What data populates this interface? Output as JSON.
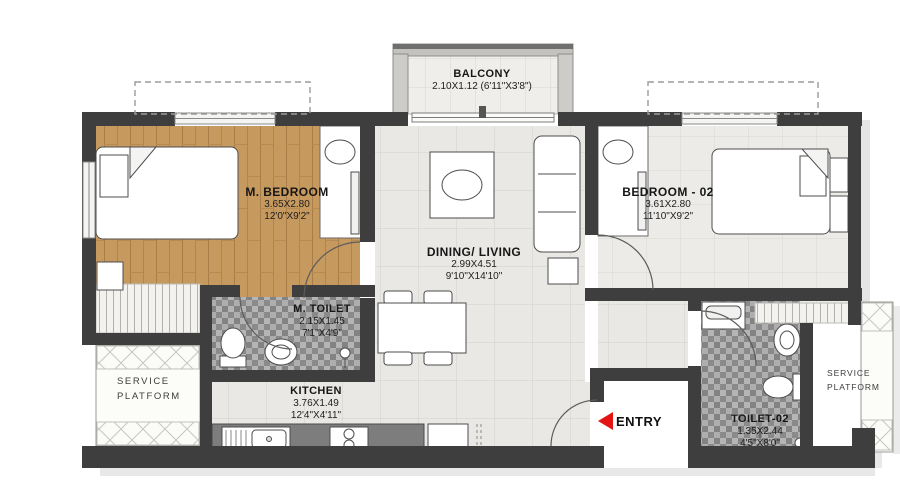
{
  "plan": {
    "balcony": {
      "name": "BALCONY",
      "dim": "2.10X1.12 (6'11\"X3'8\")"
    },
    "master_bedroom": {
      "name": "M. BEDROOM",
      "dim_m": "3.65X2.80",
      "dim_ft": "12'0\"X9'2\""
    },
    "bedroom_02": {
      "name": "BEDROOM - 02",
      "dim_m": "3.61X2.80",
      "dim_ft": "11'10\"X9'2\""
    },
    "dining_living": {
      "name": "DINING/ LIVING",
      "dim_m": "2.99X4.51",
      "dim_ft": "9'10\"X14'10\""
    },
    "master_toilet": {
      "name": "M. TOILET",
      "dim_m": "2.15X1.45",
      "dim_ft": "7'1\"X4'9\""
    },
    "kitchen": {
      "name": "KITCHEN",
      "dim_m": "3.76X1.49",
      "dim_ft": "12'4\"X4'11\""
    },
    "toilet_02": {
      "name": "TOILET-02",
      "dim_m": "1.35X2.44",
      "dim_ft": "4'5\"X8'0\""
    },
    "service_platform_left": {
      "line1": "SERVICE",
      "line2": "PLATFORM"
    },
    "service_platform_right": {
      "line1": "SERVICE",
      "line2": "PLATFORM"
    },
    "entry": {
      "label": "ENTRY"
    }
  },
  "colors": {
    "wall": "#3e3e3e",
    "wood_floor": "#c6995f",
    "tile_floor": "#e9e8e4",
    "mosaic_floor": "#9d9d9d",
    "counter": "#7d7d7d",
    "entry_arrow": "#e51414"
  }
}
